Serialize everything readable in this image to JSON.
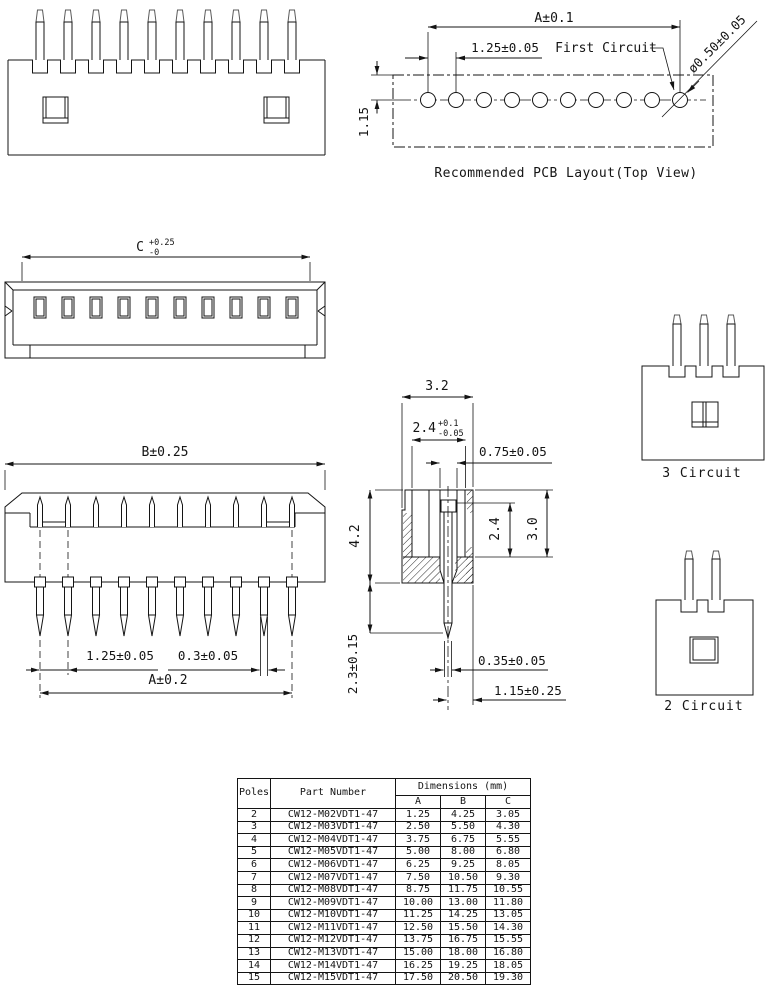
{
  "pcb": {
    "dim_a": "A±0.1",
    "pitch": "1.25±0.05",
    "first_circuit": "First Circuit",
    "hole_dia": "ø0.50±0.05",
    "edge_offset": "1.15",
    "caption": "Recommended PCB Layout(Top View)"
  },
  "top_view": {
    "c": "C",
    "c_plus": "+0.25",
    "c_minus": "-0"
  },
  "front_view": {
    "dim_b": "B±0.25",
    "pitch": "1.25±0.05",
    "pin_width": "0.3±0.05",
    "dim_a": "A±0.2"
  },
  "side_view": {
    "body_width": "3.2",
    "inner": "2.4",
    "inner_plus": "+0.1",
    "inner_minus": "-0.05",
    "slot_width": "0.75±0.05",
    "body_height": "4.2",
    "cavity_depth": "2.4",
    "total_height": "3.0",
    "tail_length": "2.3±0.15",
    "pin_thickness": "0.35±0.05",
    "pin_offset": "1.15±0.25"
  },
  "circuit_views": {
    "three": "3 Circuit",
    "two": "2 Circuit"
  },
  "table": {
    "headers": {
      "poles": "Poles",
      "part_number": "Part Number",
      "dimensions": "Dimensions (mm)",
      "a": "A",
      "b": "B",
      "c": "C"
    },
    "rows": [
      {
        "poles": "2",
        "part": "CW12-M02VDT1-47",
        "a": "1.25",
        "b": "4.25",
        "c": "3.05"
      },
      {
        "poles": "3",
        "part": "CW12-M03VDT1-47",
        "a": "2.50",
        "b": "5.50",
        "c": "4.30"
      },
      {
        "poles": "4",
        "part": "CW12-M04VDT1-47",
        "a": "3.75",
        "b": "6.75",
        "c": "5.55"
      },
      {
        "poles": "5",
        "part": "CW12-M05VDT1-47",
        "a": "5.00",
        "b": "8.00",
        "c": "6.80"
      },
      {
        "poles": "6",
        "part": "CW12-M06VDT1-47",
        "a": "6.25",
        "b": "9.25",
        "c": "8.05"
      },
      {
        "poles": "7",
        "part": "CW12-M07VDT1-47",
        "a": "7.50",
        "b": "10.50",
        "c": "9.30"
      },
      {
        "poles": "8",
        "part": "CW12-M08VDT1-47",
        "a": "8.75",
        "b": "11.75",
        "c": "10.55"
      },
      {
        "poles": "9",
        "part": "CW12-M09VDT1-47",
        "a": "10.00",
        "b": "13.00",
        "c": "11.80"
      },
      {
        "poles": "10",
        "part": "CW12-M10VDT1-47",
        "a": "11.25",
        "b": "14.25",
        "c": "13.05"
      },
      {
        "poles": "11",
        "part": "CW12-M11VDT1-47",
        "a": "12.50",
        "b": "15.50",
        "c": "14.30"
      },
      {
        "poles": "12",
        "part": "CW12-M12VDT1-47",
        "a": "13.75",
        "b": "16.75",
        "c": "15.55"
      },
      {
        "poles": "13",
        "part": "CW12-M13VDT1-47",
        "a": "15.00",
        "b": "18.00",
        "c": "16.80"
      },
      {
        "poles": "14",
        "part": "CW12-M14VDT1-47",
        "a": "16.25",
        "b": "19.25",
        "c": "18.05"
      },
      {
        "poles": "15",
        "part": "CW12-M15VDT1-47",
        "a": "17.50",
        "b": "20.50",
        "c": "19.30"
      }
    ]
  }
}
